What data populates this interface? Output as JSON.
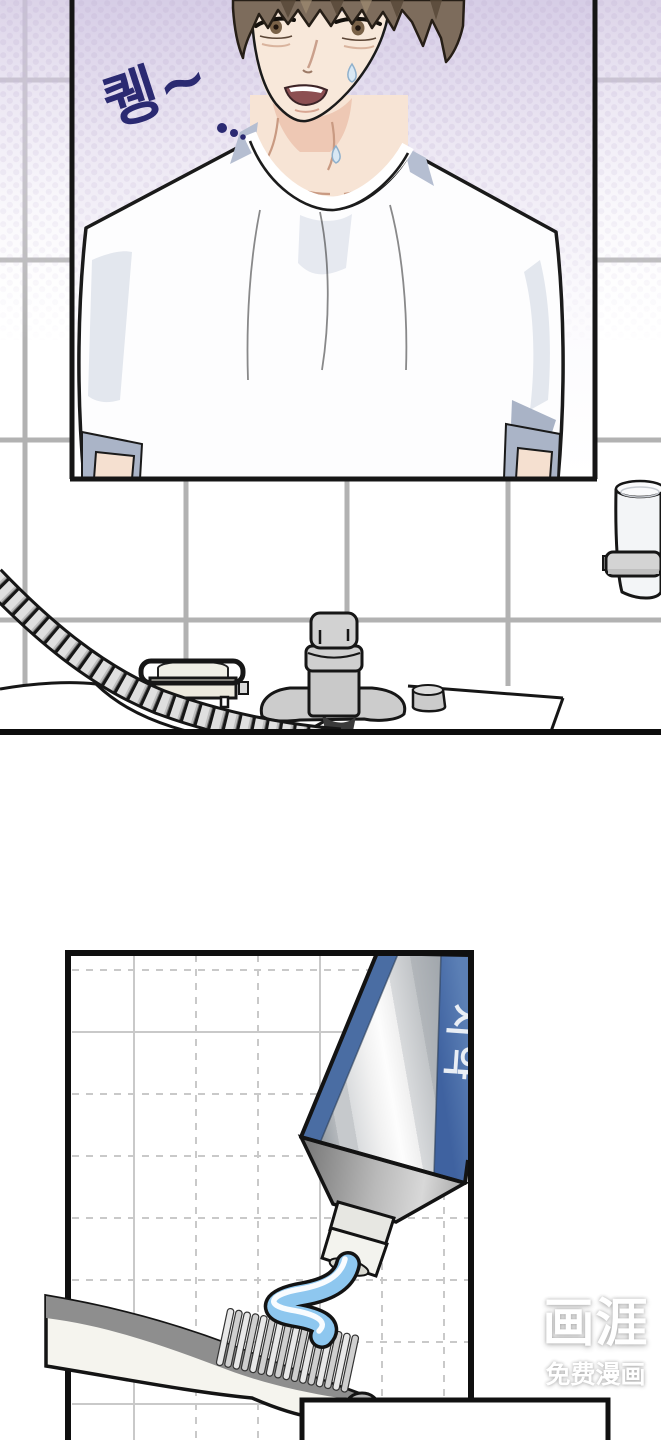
{
  "page": {
    "width": 661,
    "height": 1440,
    "background": "#ffffff"
  },
  "top_panel": {
    "sfx": {
      "text": "퀭~",
      "color": "#2b2a72"
    },
    "objects": [
      "tiled-wall",
      "mirror",
      "man-reflection",
      "white-tshirt",
      "soap-dish",
      "faucet",
      "drain-knob",
      "shower-hose",
      "glass-cup",
      "sink-counter"
    ]
  },
  "bottom_panel": {
    "tube_label": {
      "text": "치약",
      "color": "#e9eef5",
      "band_color": "#4a6da3"
    },
    "paste_color": "#8ec7ef",
    "objects": [
      "tile-grid",
      "toothpaste-tube",
      "tube-nozzle",
      "toothpaste-squeeze",
      "toothbrush",
      "bristles",
      "speech-bubble"
    ]
  },
  "watermark": {
    "title": "画涯",
    "subtitle": "免费漫画",
    "color": "#ffffff"
  }
}
